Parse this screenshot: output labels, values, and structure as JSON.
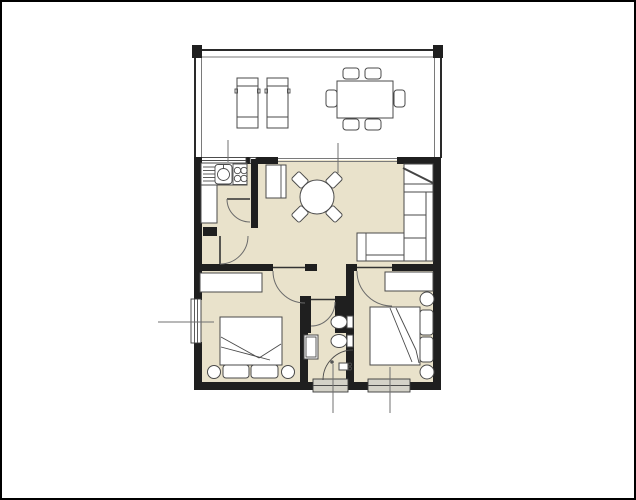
{
  "title": "apartment-floor-plan",
  "colors": {
    "background": "#ffffff",
    "frame": "#000000",
    "floor": "#e9e2cb",
    "wall": "#1f1f1f",
    "furniture_fill": "#ffffff",
    "furniture_outline": "#4a4a4a",
    "window_fill": "#d4d2c8",
    "door_arc": "#6b6b6b",
    "leader_line": "#707070"
  },
  "rooms": [
    {
      "name": "terrace",
      "furniture": [
        "sun-lounger",
        "sun-lounger",
        "dining-table"
      ],
      "chairs": 6
    },
    {
      "name": "kitchen",
      "furniture": [
        "countertop",
        "drainboard",
        "sink",
        "hob-4-burners",
        "base-counter",
        "tall-cabinet"
      ]
    },
    {
      "name": "living-room",
      "furniture": [
        "round-table",
        "corner-sofa",
        "entrance-door"
      ],
      "chairs": 4
    },
    {
      "name": "bedroom-left",
      "furniture": [
        "wardrobe",
        "double-bed",
        "pillow",
        "pillow",
        "nightstand",
        "nightstand",
        "window"
      ]
    },
    {
      "name": "bathroom",
      "furniture": [
        "shower",
        "toilet",
        "bidet",
        "washbasin",
        "window"
      ]
    },
    {
      "name": "bedroom-right",
      "furniture": [
        "wardrobe",
        "double-bed",
        "pillow",
        "pillow",
        "nightstand",
        "nightstand",
        "window"
      ]
    }
  ],
  "annotations": {
    "leader_lines": 5,
    "door_arcs": 5
  }
}
